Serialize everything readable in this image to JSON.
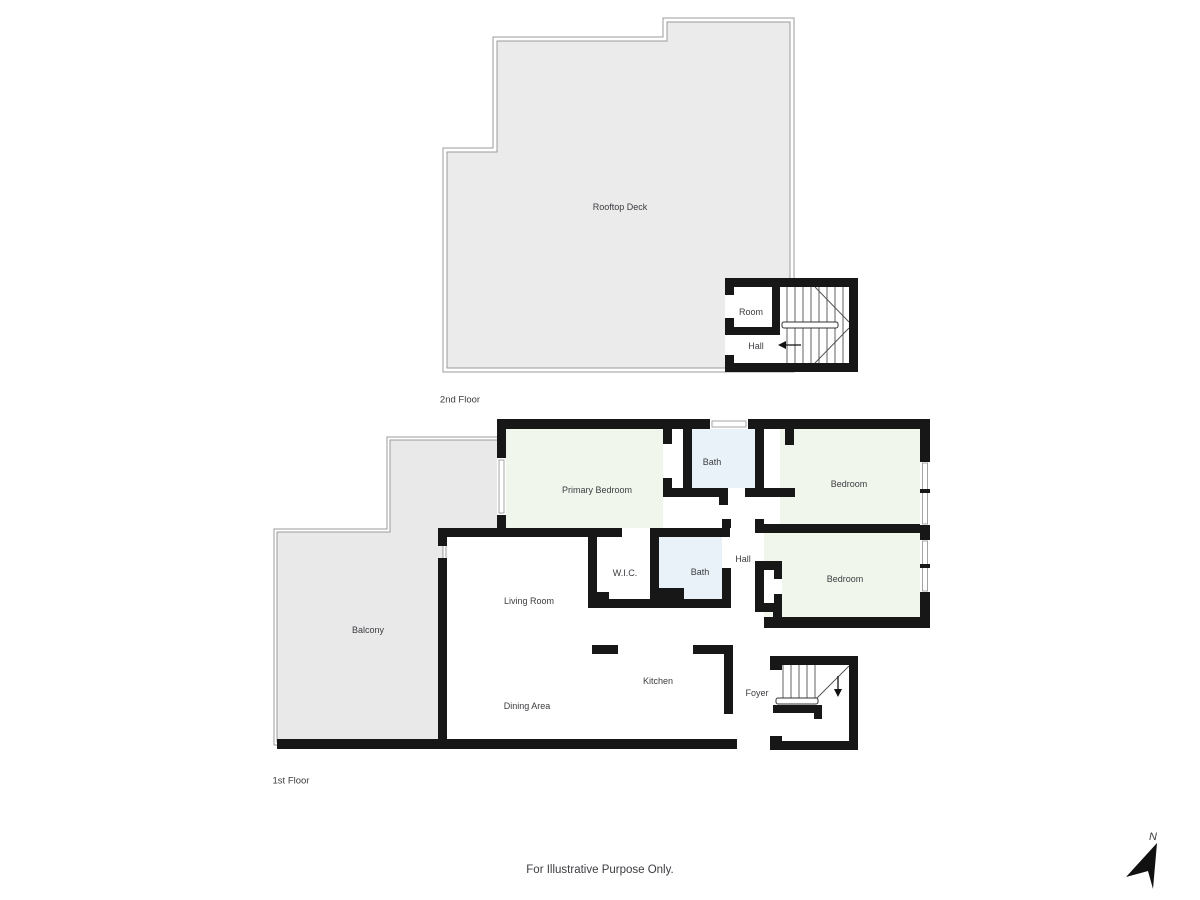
{
  "page": {
    "footer_note": "For Illustrative Purpose Only.",
    "compass_label": "N"
  },
  "colors": {
    "wall": "#171717",
    "deck_fill": "#ebebec",
    "balcony_fill": "#e9e9ea",
    "outline": "#9b9b9b",
    "bedroom_fill": "#f1f6ec",
    "bath_fill": "#e9f2f8",
    "label_text": "#3c3c41",
    "stair_line": "#4f4f4f",
    "page_bg": "#ffffff"
  },
  "floor2": {
    "caption": "2nd Floor",
    "rooms": {
      "rooftop_deck": "Rooftop Deck",
      "room": "Room",
      "hall": "Hall"
    }
  },
  "floor1": {
    "caption": "1st Floor",
    "rooms": {
      "primary_bedroom": "Primary Bedroom",
      "bath_upper": "Bath",
      "bedroom_upper": "Bedroom",
      "bedroom_lower": "Bedroom",
      "hall": "Hall",
      "wic": "W.I.C.",
      "bath_middle": "Bath",
      "living_room": "Living Room",
      "balcony": "Balcony",
      "kitchen": "Kitchen",
      "dining_area": "Dining Area",
      "foyer": "Foyer"
    }
  }
}
